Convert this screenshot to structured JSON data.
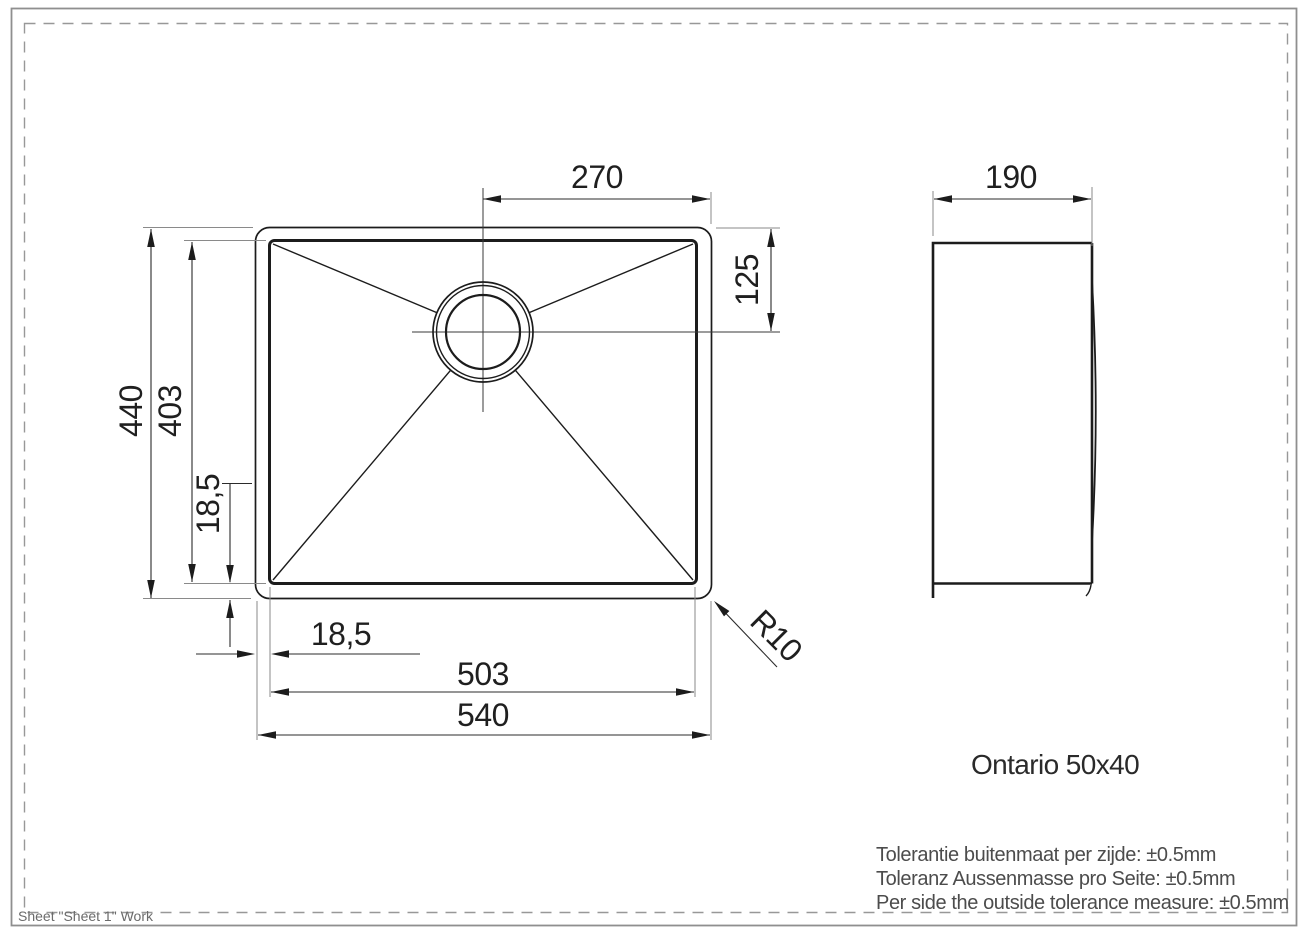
{
  "labels": {
    "dim_270": "270",
    "dim_190": "190",
    "dim_125": "125",
    "dim_440": "440",
    "dim_403": "403",
    "dim_18_5_left": "18,5",
    "dim_18_5_bottom": "18,5",
    "dim_503": "503",
    "dim_540": "540",
    "radius_r10": "R10",
    "title": "Ontario 50x40",
    "tol_nl": "Tolerantie buitenmaat per zijde: ±0.5mm",
    "tol_de": "Toleranz Aussenmasse pro Seite: ±0.5mm",
    "tol_en": "Per side the outside tolerance measure: ±0.5mm",
    "footer": "Sheet \"Sheet 1\" Work"
  },
  "model": {
    "name": "Ontario 50x40",
    "units": "mm",
    "outer_width": 540,
    "outer_depth": 440,
    "bowl_width": 503,
    "bowl_depth": 403,
    "rim_offset_per_side": "18,5",
    "drain_center_to_right_outer_edge": 270,
    "drain_center_to_top_outer_edge": 125,
    "side_view_depth": 190,
    "corner_radius": "R10",
    "tolerance_per_side_mm": 0.5
  }
}
